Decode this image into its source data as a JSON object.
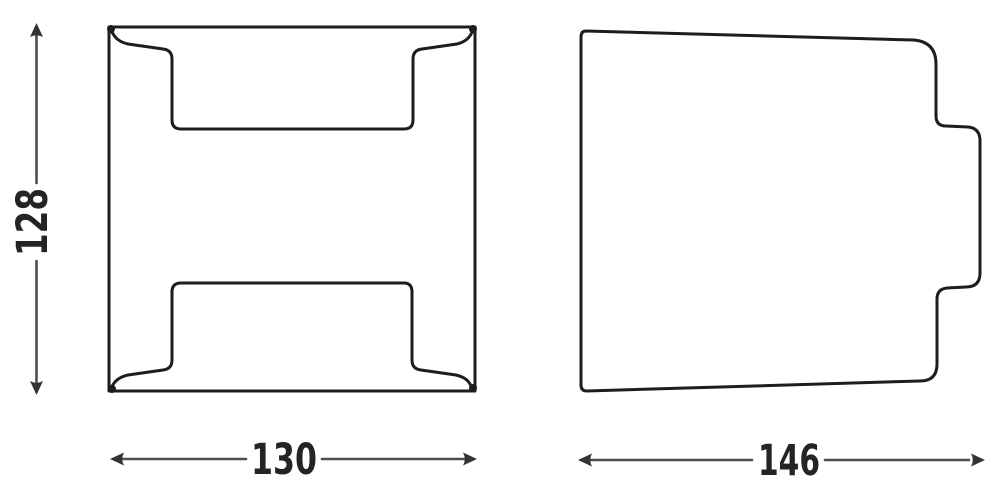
{
  "colors": {
    "background": "#ffffff",
    "outline": "#1d1d1d",
    "dimension_line": "#4e4e4e",
    "dimension_text": "#242424"
  },
  "drawing": {
    "type": "technical-dimension-drawing",
    "views": [
      {
        "id": "front-view",
        "shape": "square housing with top and bottom recessed brackets"
      },
      {
        "id": "side-view",
        "shape": "tapered side profile with rear mounting tab"
      }
    ],
    "dimensions": {
      "height": "128",
      "front_width": "130",
      "side_depth": "146"
    }
  }
}
